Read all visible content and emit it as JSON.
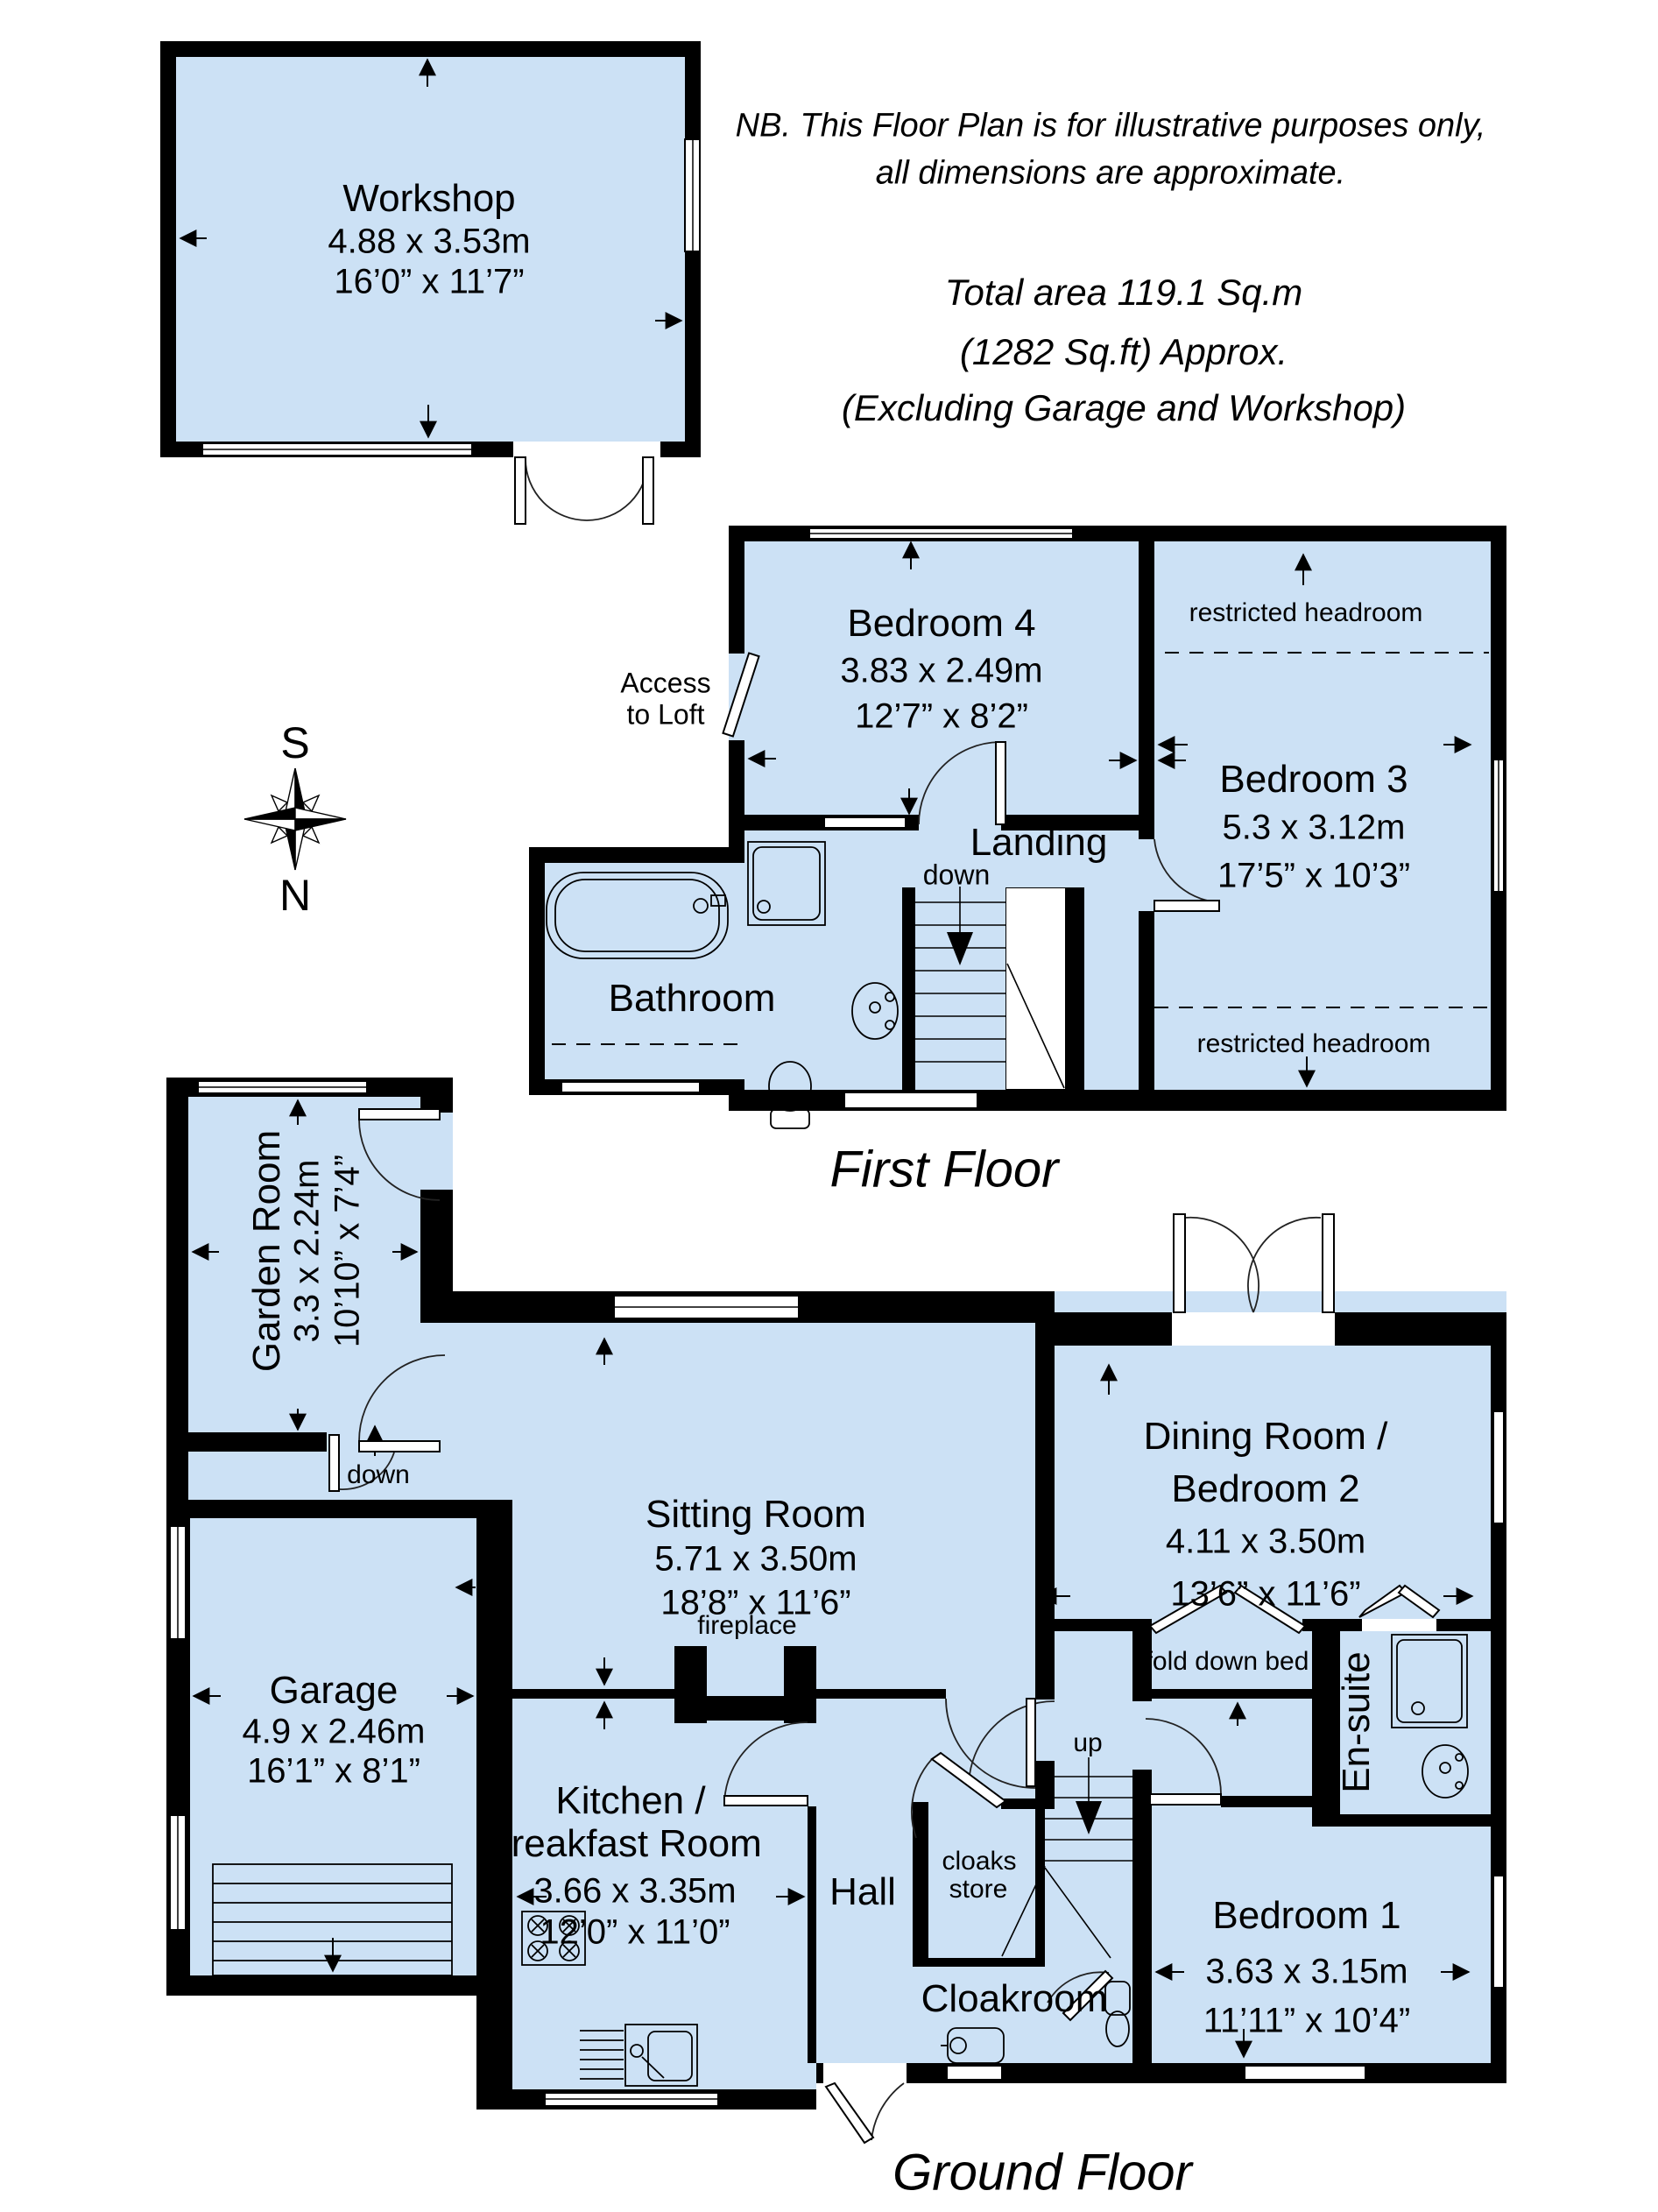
{
  "notes": {
    "line1": "NB. This Floor Plan is for illustrative purposes only,",
    "line2": "all dimensions are approximate."
  },
  "total_area": {
    "line1": "Total area 119.1 Sq.m",
    "line2": "(1282 Sq.ft) Approx.",
    "line3": "(Excluding Garage and Workshop)"
  },
  "compass": {
    "south": "S",
    "north": "N"
  },
  "floors": {
    "first": "First Floor",
    "ground": "Ground Floor"
  },
  "rooms": {
    "workshop": {
      "name": "Workshop",
      "metric": "4.88 x 3.53m",
      "imperial": "16’0” x 11’7”"
    },
    "bedroom4": {
      "name": "Bedroom 4",
      "metric": "3.83 x 2.49m",
      "imperial": "12’7” x 8’2”"
    },
    "bedroom3": {
      "name": "Bedroom 3",
      "metric": "5.3 x 3.12m",
      "imperial": "17’5” x 10’3”"
    },
    "bathroom": {
      "name": "Bathroom"
    },
    "landing": {
      "name": "Landing"
    },
    "garden_room": {
      "name": "Garden Room",
      "metric": "3.3 x 2.24m",
      "imperial": "10’10” x 7’4”"
    },
    "sitting_room": {
      "name": "Sitting Room",
      "metric": "5.71 x 3.50m",
      "imperial": "18’8” x 11’6”"
    },
    "dining_room": {
      "name1": "Dining Room /",
      "name2": "Bedroom 2",
      "metric": "4.11 x 3.50m",
      "imperial": "13’6” x 11’6”"
    },
    "garage": {
      "name": "Garage",
      "metric": "4.9 x 2.46m",
      "imperial": "16’1” x 8’1”"
    },
    "kitchen": {
      "name1": "Kitchen /",
      "name2": "Breakfast Room",
      "metric": "3.66 x 3.35m",
      "imperial": "12’0” x 11’0”"
    },
    "hall": {
      "name": "Hall"
    },
    "cloakroom": {
      "name": "Cloakroom"
    },
    "bedroom1": {
      "name": "Bedroom 1",
      "metric": "3.63 x 3.15m",
      "imperial": "11’11” x 10’4”"
    },
    "ensuite": {
      "name": "En-suite"
    }
  },
  "annotations": {
    "access_loft1": "Access",
    "access_loft2": "to Loft",
    "restricted": "restricted headroom",
    "down": "down",
    "up": "up",
    "fireplace": "fireplace",
    "fold_down_bed": "fold down bed",
    "cloaks1": "cloaks",
    "cloaks2": "store"
  },
  "colors": {
    "room_fill": "#cce1f5",
    "wall": "#000000"
  }
}
